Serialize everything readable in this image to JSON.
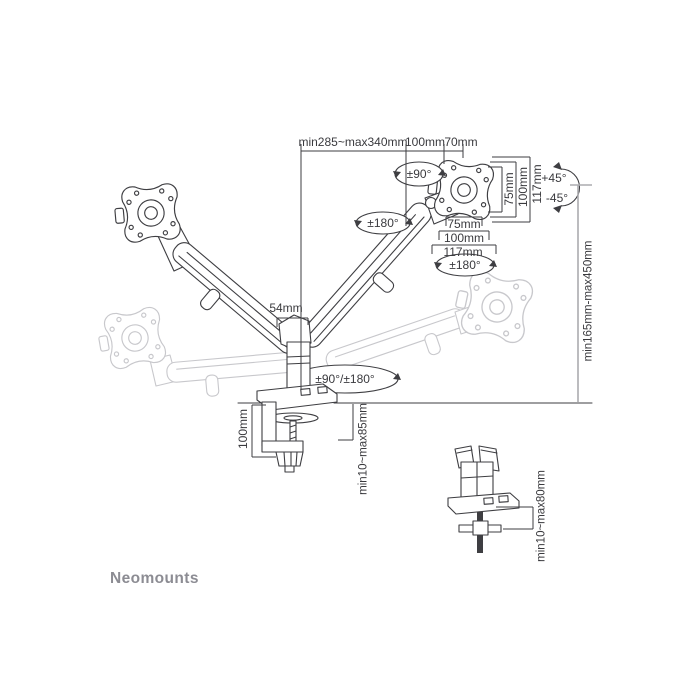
{
  "brand": {
    "name": "Neomounts"
  },
  "colors": {
    "line": "#3e3e42",
    "ghost": "#c8c8cc",
    "dim_text": "#3a3a3e",
    "height_line": "#ababaf",
    "logo": "#8c8c93",
    "bg": "#ffffff"
  },
  "annotations": {
    "arm_reach": "min285~max340mm",
    "plate_width": "100mm",
    "plate_offset": "70mm",
    "head_swivel": "±90°",
    "left_elbow_rotation": "±180°",
    "right_vesa_rotation": "±180°",
    "tilt_up": "+45°",
    "tilt_down": "-45°",
    "vesa_vertical": {
      "v75": "75mm",
      "v100": "100mm",
      "v117": "117mm"
    },
    "vesa_horizontal": {
      "h75": "75mm",
      "h100": "100mm",
      "h117": "117mm"
    },
    "pole_width": "54mm",
    "height_range": "min165mm-max450mm",
    "base_rotation": "±90°/±180°",
    "clamp_height": "100mm",
    "clamp_desk_range": "min10~max85mm",
    "grommet_desk_range": "min10~max80mm"
  }
}
